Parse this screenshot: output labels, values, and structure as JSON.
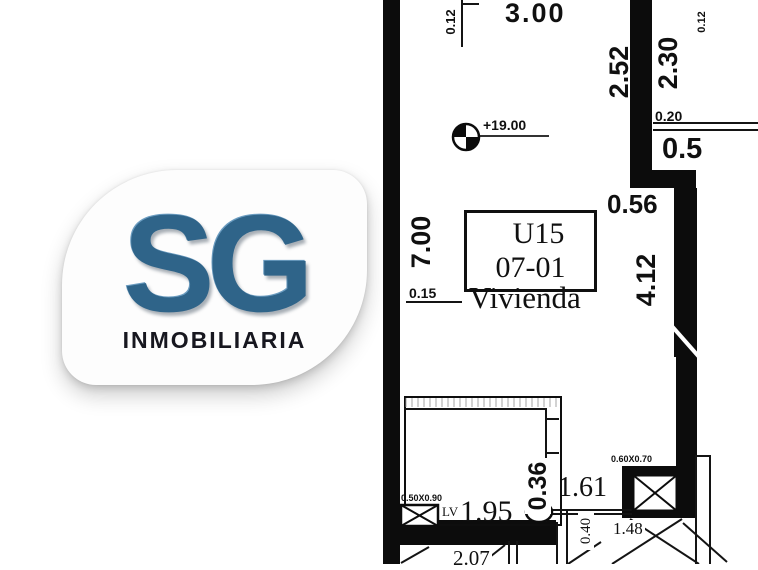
{
  "logo": {
    "initials": "SG",
    "subtitle": "INMOBILIARIA"
  },
  "colors": {
    "ink": "#0c0c0c",
    "logo_blue": "#2f6489",
    "logo_text": "#17171f",
    "paper": "#ffffff"
  },
  "plan": {
    "unit_box": {
      "line1": "U15",
      "line2": "07-01"
    },
    "room_type": "Vivienda",
    "level_mark": "+19.00",
    "dims": {
      "d012_top_left": "0.12",
      "d300_top": "3.00",
      "d252_right": "2.52",
      "d230_right": "2.30",
      "d012_top_right": "0.12",
      "d020_right": "0.20",
      "d05_right": "0.5",
      "d700_left": "7.00",
      "d056_mid": "0.56",
      "d412_mid": "4.12",
      "d015_left": "0.15",
      "d036_bath": "0.36",
      "d161_hall": "1.61",
      "shaft_size": "0.60X0.70",
      "fixture_size": "0.50X0.90",
      "fixture_label": "LV",
      "d195_bath": "1.95",
      "d040_low": "0.40",
      "d148_low": "1.48",
      "d207_bottom": "2.07"
    }
  }
}
